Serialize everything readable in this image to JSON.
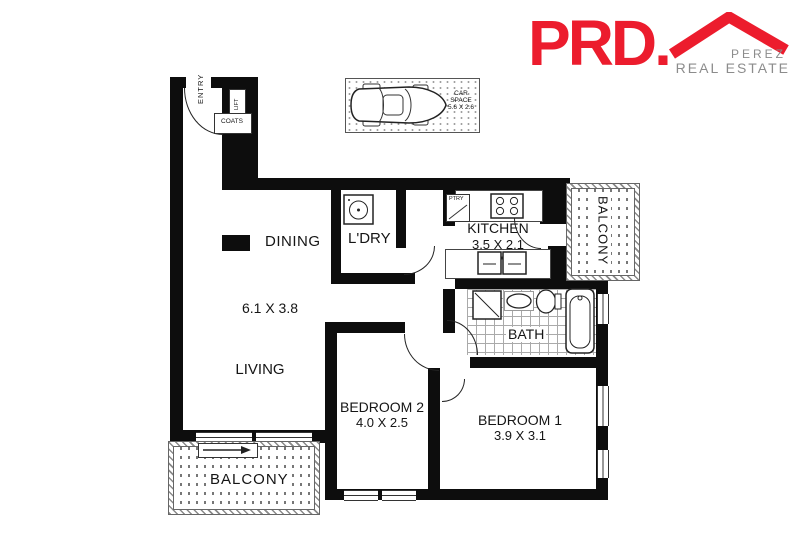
{
  "brand": {
    "logo": "PRD.",
    "agency_top": "PEREZ",
    "agency_bottom": "REAL ESTATE",
    "logo_red": "#ec1c2d",
    "logo_gray": "#8c8c8c"
  },
  "plan": {
    "entry": "ENTRY",
    "lift": "LIFT",
    "coats": "COATS",
    "dining": "DINING",
    "laundry": "L'DRY",
    "pantry": "PTRY",
    "kitchen": "KITCHEN",
    "kitchen_dim": "3.5 X 2.1",
    "balcony_right": "BALCONY",
    "living": "LIVING",
    "living_dim": "6.1 X 3.8",
    "bath": "BATH",
    "bedroom2": "BEDROOM 2",
    "bedroom2_dim": "4.0 X 2.5",
    "bedroom1": "BEDROOM 1",
    "bedroom1_dim": "3.9 X 3.1",
    "balcony_bottom": "BALCONY",
    "car_line1": "CAR",
    "car_line2": "SPACE",
    "car_dim": "5.6 X 2.6"
  },
  "colors": {
    "wall": "#0d0d0d",
    "line": "#333333",
    "hatch_gray": "#8a8a8a"
  }
}
